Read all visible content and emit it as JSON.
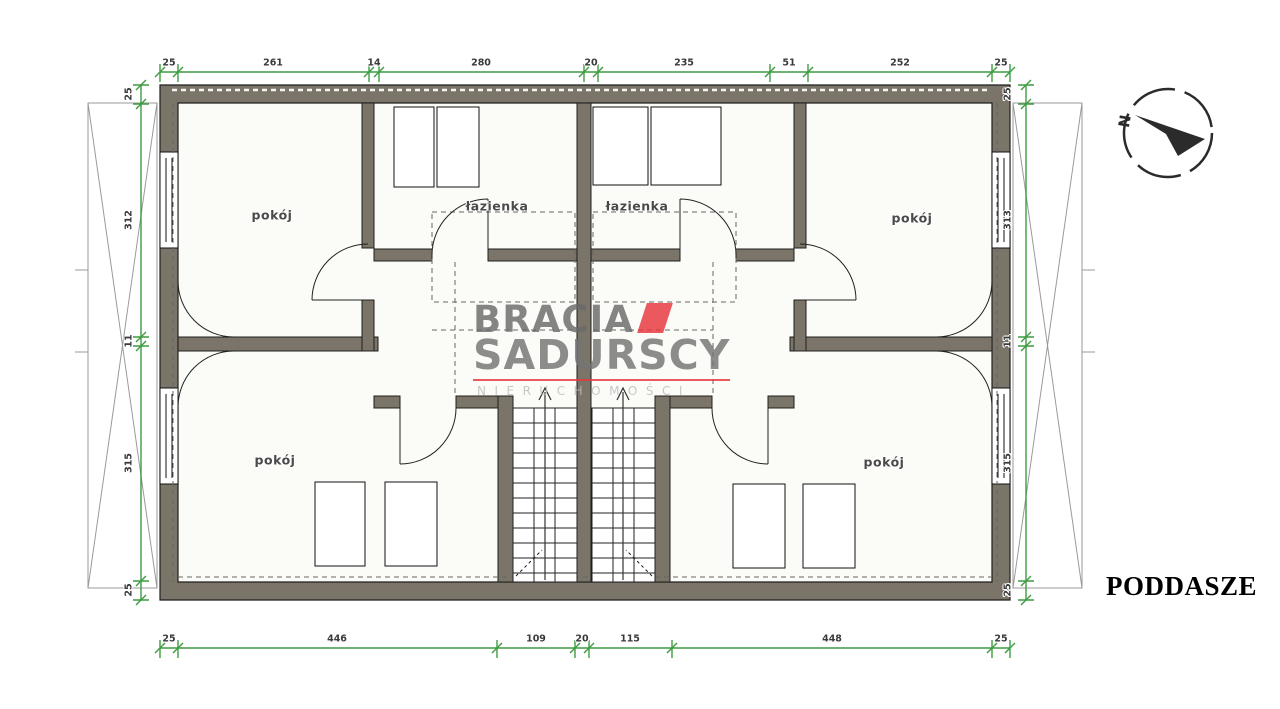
{
  "page": {
    "title": "PODDASZE"
  },
  "compass": {
    "north": "N"
  },
  "watermark": {
    "brand_line1": "BRACIA",
    "brand_line2": "SADURSCY",
    "brand_line3": "NIERUCHOMOŚCI"
  },
  "rooms": {
    "pokoj_top_left": "pokój",
    "pokoj_top_right": "pokój",
    "pokoj_bottom_left": "pokój",
    "pokoj_bottom_right": "pokój",
    "lazienka_left": "łazienka",
    "lazienka_right": "łazienka"
  },
  "dimensions": {
    "top": [
      "25",
      "261",
      "14",
      "280",
      "20",
      "235",
      "51",
      "252",
      "25"
    ],
    "bottom": [
      "25",
      "446",
      "109",
      "20",
      "115",
      "448",
      "25"
    ],
    "left": [
      "25",
      "312",
      "11",
      "315",
      "25"
    ],
    "right": [
      "25",
      "313",
      "11",
      "315",
      "25"
    ]
  },
  "colors": {
    "wall_fill": "#7b7468",
    "dimension_green": "#3d9c40",
    "logo_red": "#e8363d",
    "watermark_gray": "#747474"
  }
}
